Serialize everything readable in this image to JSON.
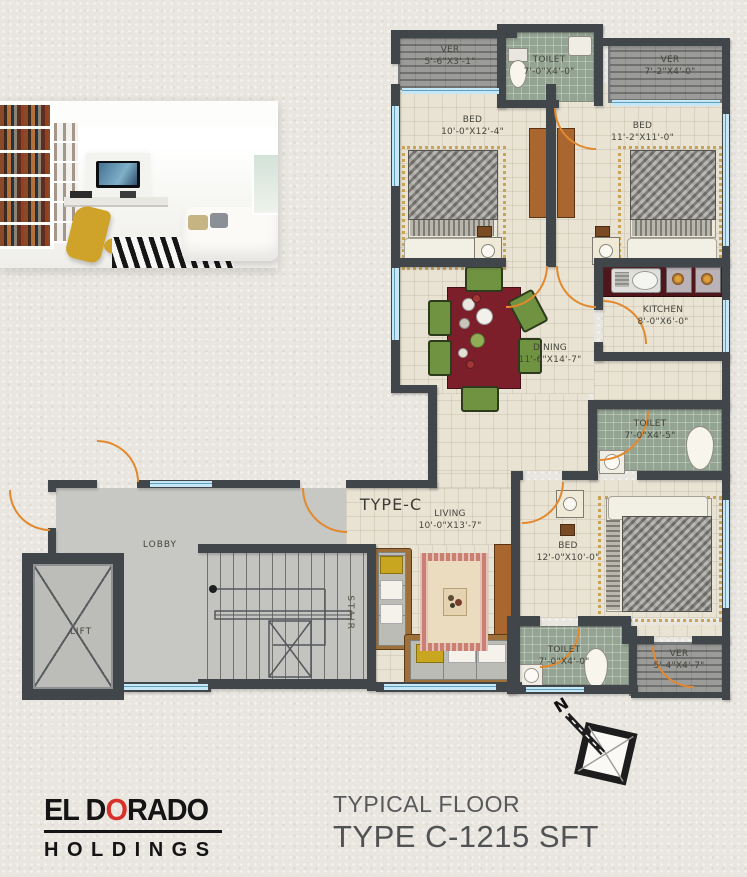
{
  "brand": {
    "name_pre": "EL D",
    "name_o": "O",
    "name_post": "RADO",
    "sub": "HOLDINGS"
  },
  "plan_title": {
    "line1": "TYPICAL FLOOR",
    "line2": "TYPE C-1215 SFT"
  },
  "unit_type_label": "TYPE-C",
  "north_label": "N",
  "rooms": {
    "ver_top_left": {
      "name": "VER",
      "dims": "5'-6\"X3'-1\""
    },
    "toilet_top": {
      "name": "TOILET",
      "dims": "7'-0\"X4'-0\""
    },
    "ver_top_right": {
      "name": "VER",
      "dims": "7'-2\"X4'-0\""
    },
    "bed1": {
      "name": "BED",
      "dims": "10'-0\"X12'-4\""
    },
    "bed2": {
      "name": "BED",
      "dims": "11'-2\"X11'-0\""
    },
    "kitchen": {
      "name": "KITCHEN",
      "dims": "8'-0\"X6'-0\""
    },
    "dining": {
      "name": "DINING",
      "dims": "11'-6\"X14'-7\""
    },
    "toilet_mid": {
      "name": "TOILET",
      "dims": "7'-0\"X4'-5\""
    },
    "bed3": {
      "name": "BED",
      "dims": "12'-0\"X10'-0\""
    },
    "toilet_bottom": {
      "name": "TOILET",
      "dims": "7'-0\"X4'-0\""
    },
    "ver_bottom": {
      "name": "VER",
      "dims": "5'-4\"X4'-7\""
    },
    "living": {
      "name": "LIVING",
      "dims": "10'-0\"X13'-7\""
    },
    "lobby": {
      "name": "LOBBY"
    },
    "lift": {
      "name": "LIFT"
    },
    "stair": {
      "name": "STAIR"
    }
  },
  "colors": {
    "wall": "#41464b",
    "door": "#e2892f",
    "window": "#a9d9ec",
    "floor": "#e9e3d3",
    "toilet_floor": "#94a492",
    "veranda_floor": "#9b9b99",
    "lobby_floor": "#c7c7c4",
    "dining_table": "#7c1f2a",
    "chair": "#6f9340",
    "kitchen_counter": "#4f161c",
    "brand_accent": "#d6322b"
  }
}
